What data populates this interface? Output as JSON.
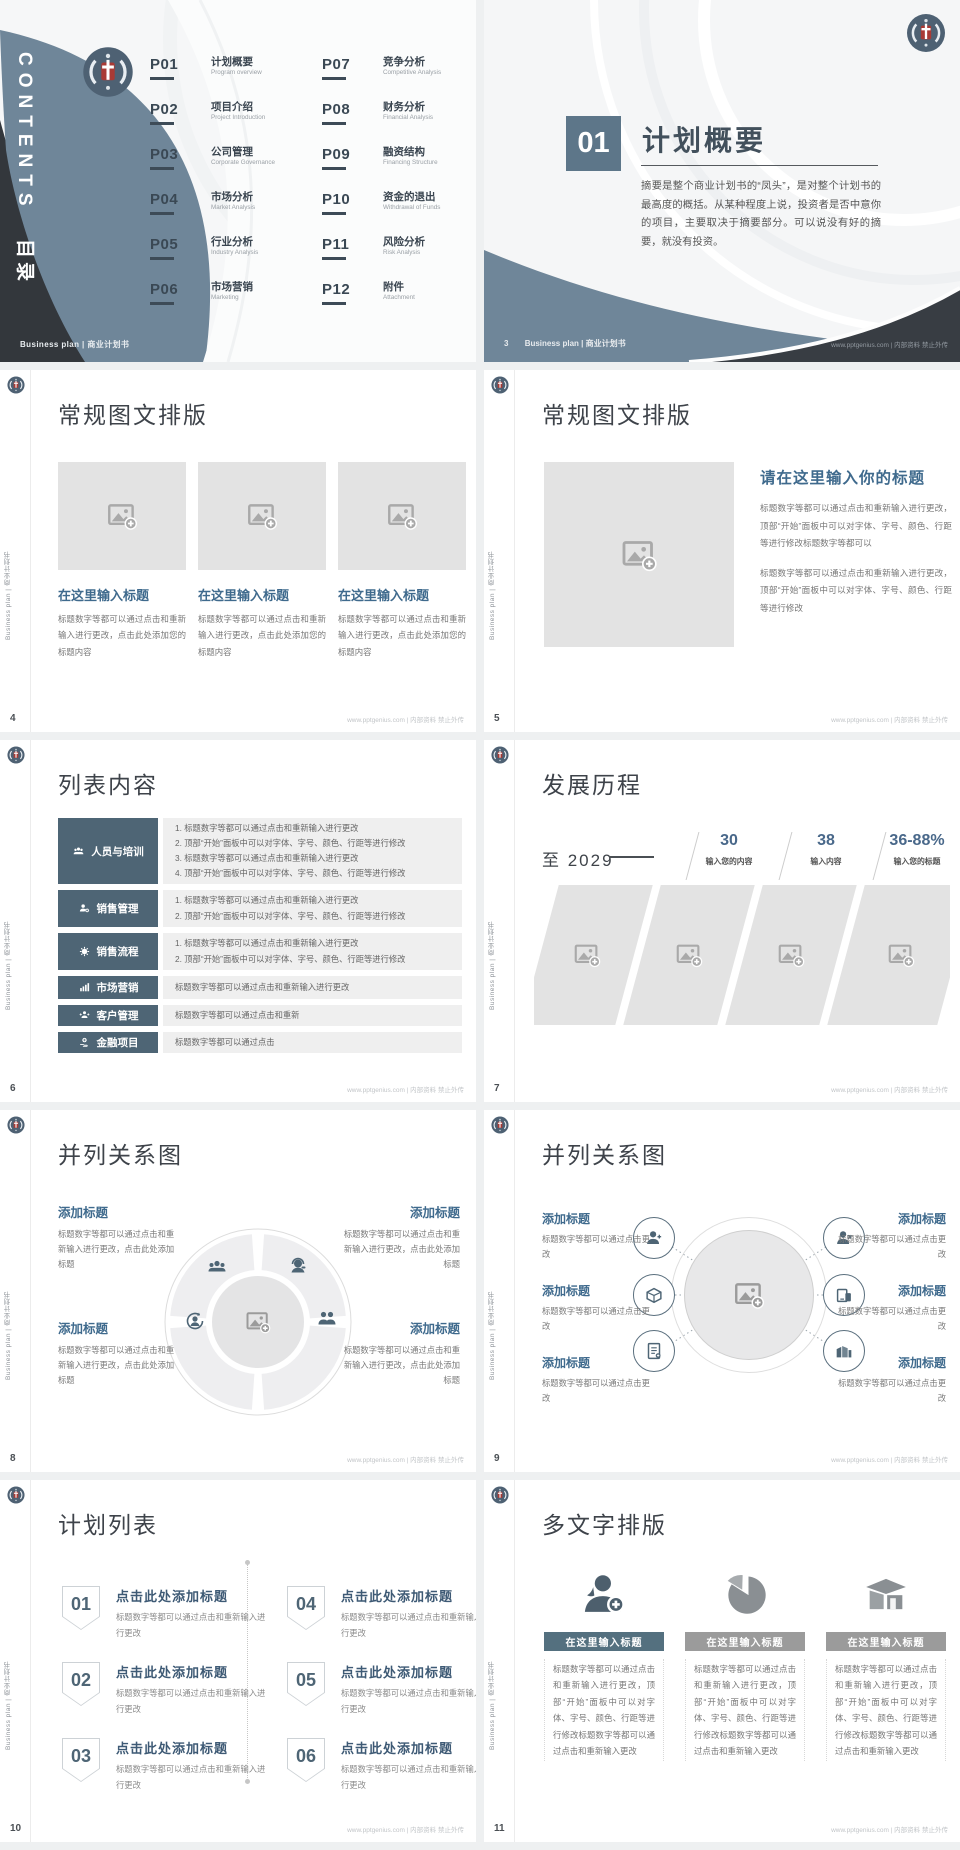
{
  "page": {
    "background": "#eef0f1"
  },
  "brand": {
    "accent_dark": "#4e6575",
    "band_blue": "#72889b",
    "charcoal": "#34383d",
    "heading_blue": "#3f6a8d",
    "number_blue": "#49688a",
    "logo": "university-emblem"
  },
  "common": {
    "sidebar_text": "Business plan | 商业计划书",
    "footer_right": "www.pptgenius.com | 内部资料 禁止外传"
  },
  "slides": {
    "cover": {
      "vertical_en": "CONTENTS",
      "vertical_zh": "目录",
      "footer_left": "Business plan | 商业计划书",
      "items": [
        {
          "num": "P01",
          "zh": "计划概要",
          "en": "Program overview"
        },
        {
          "num": "P02",
          "zh": "项目介绍",
          "en": "Project Introduction"
        },
        {
          "num": "P03",
          "zh": "公司管理",
          "en": "Corporate Governance"
        },
        {
          "num": "P04",
          "zh": "市场分析",
          "en": "Market Analysis"
        },
        {
          "num": "P05",
          "zh": "行业分析",
          "en": "Industry Analysis"
        },
        {
          "num": "P06",
          "zh": "市场营销",
          "en": "Marketing"
        },
        {
          "num": "P07",
          "zh": "竞争分析",
          "en": "Competitive Analysis"
        },
        {
          "num": "P08",
          "zh": "财务分析",
          "en": "Financial Analysis"
        },
        {
          "num": "P09",
          "zh": "融资结构",
          "en": "Financing Structure"
        },
        {
          "num": "P10",
          "zh": "资金的退出",
          "en": "Withdrawal of Funds"
        },
        {
          "num": "P11",
          "zh": "风险分析",
          "en": "Risk Analysis"
        },
        {
          "num": "P12",
          "zh": "附件",
          "en": "Attachment"
        }
      ]
    },
    "section": {
      "number": "01",
      "title": "计划概要",
      "body": "摘要是整个商业计划书的“凤头”，是对整个计划书的最高度的概括。从某种程度上说，投资者是否中意你的项目，主要取决于摘要部分。可以说没有好的摘要，就没有投资。",
      "page": "3",
      "footer_left": "Business plan | 商业计划书"
    },
    "layout_three": {
      "title": "常规图文排版",
      "page": "4",
      "heading": "在这里输入标题",
      "body": "标题数字等都可以通过点击和重新输入进行更改，点击此处添加您的标题内容"
    },
    "layout_single": {
      "title": "常规图文排版",
      "page": "5",
      "heading": "请在这里输入你的标题",
      "p1": "标题数字等都可以通过点击和重新输入进行更改，顶部“开始”面板中可以对字体、字号、颜色、行距等进行修改标题数字等都可以",
      "p2": "标题数字等都可以通过点击和重新输入进行更改，顶部“开始”面板中可以对字体、字号、颜色、行距等进行修改"
    },
    "list_content": {
      "title": "列表内容",
      "page": "6",
      "rows": [
        {
          "label": "人员与培训",
          "icon": "users-icon",
          "lines": [
            "1. 标题数字等都可以通过点击和重新输入进行更改",
            "2. 顶部“开始”面板中可以对字体、字号、颜色、行距等进行修改",
            "3. 标题数字等都可以通过点击和重新输入进行更改",
            "4. 顶部“开始”面板中可以对字体、字号、颜色、行距等进行修改"
          ]
        },
        {
          "label": "销售管理",
          "icon": "user-gear-icon",
          "lines": [
            "1. 标题数字等都可以通过点击和重新输入进行更改",
            "2. 顶部“开始”面板中可以对字体、字号、颜色、行距等进行修改"
          ]
        },
        {
          "label": "销售流程",
          "icon": "gear-icon",
          "lines": [
            "1. 标题数字等都可以通过点击和重新输入进行更改",
            "2. 顶部“开始”面板中可以对字体、字号、颜色、行距等进行修改"
          ]
        },
        {
          "label": "市场营销",
          "icon": "bar-chart-icon",
          "lines": [
            "标题数字等都可以通过点击和重新输入进行更改"
          ]
        },
        {
          "label": "客户管理",
          "icon": "customers-icon",
          "lines": [
            "标题数字等都可以通过点击和重新"
          ]
        },
        {
          "label": "金融项目",
          "icon": "finance-icon",
          "lines": [
            "标题数字等都可以通过点击"
          ]
        }
      ]
    },
    "timeline": {
      "title": "发展历程",
      "page": "7",
      "era": "至 2029",
      "stats": [
        {
          "value": "30",
          "label": "输入您的内容"
        },
        {
          "value": "38",
          "label": "输入内容"
        },
        {
          "value": "36-88%",
          "label": "输入您的标题"
        }
      ]
    },
    "relation_wheel": {
      "title": "并列关系图",
      "page": "8",
      "heading": "添加标题",
      "body": "标题数字等都可以通过点击和重新输入进行更改，点击此处添加标题"
    },
    "relation_hub": {
      "title": "并列关系图",
      "page": "9",
      "heading": "添加标题",
      "body": "标题数字等都可以通过点击更改"
    },
    "plan_list": {
      "title": "计划列表",
      "page": "10",
      "heading": "点击此处添加标题",
      "body": "标题数字等都可以通过点击和重新输入进行更改",
      "nums": [
        "01",
        "02",
        "03",
        "04",
        "05",
        "06"
      ]
    },
    "multi_text": {
      "title": "多文字排版",
      "page": "11",
      "heading": "在这里输入标题",
      "body": "标题数字等都可以通过点击和重新输入进行更改，顶部“开始”面板中可以对字体、字号、颜色、行距等进行修改标题数字等都可以通过点击和重新输入更改"
    }
  }
}
